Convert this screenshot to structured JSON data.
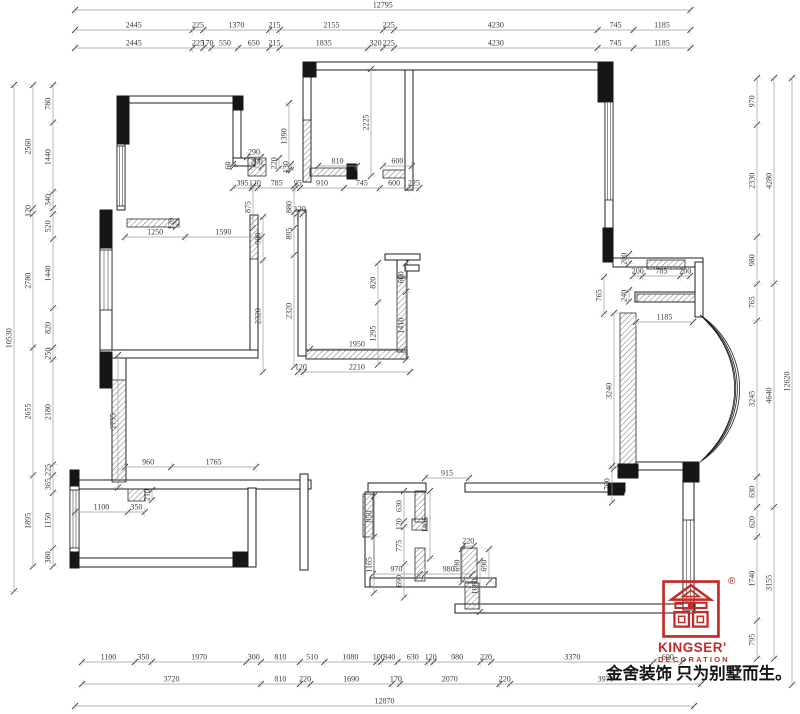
{
  "dims": {
    "top": {
      "total": "12795",
      "row2": [
        "2445",
        "225",
        "1370",
        "215",
        "2155",
        "225",
        "4230",
        "745",
        "1185"
      ],
      "row3": [
        "2445",
        "225",
        "170",
        "550",
        "650",
        "215",
        "1835",
        "320",
        "225",
        "4230",
        "745",
        "1185"
      ]
    },
    "bottom": {
      "row1": [
        "1100",
        "350",
        "1970",
        "300",
        "810",
        "510",
        "1080",
        "100",
        "340",
        "630",
        "120",
        "980",
        "220",
        "3370",
        "600"
      ],
      "row2": [
        "3720",
        "810",
        "220",
        "1690",
        "170",
        "2070",
        "220",
        "3970"
      ],
      "total": "12870"
    },
    "left": {
      "total": "10530",
      "mid": [
        "2560",
        "120",
        "2780",
        "2655",
        "1895"
      ],
      "inner": [
        "780",
        "1440",
        "340",
        "120*",
        "520",
        "1440",
        "820",
        "250",
        "2180",
        "225",
        "365",
        "1150",
        "380"
      ]
    },
    "right": {
      "total": "12620",
      "mid": [
        "4280",
        "4640",
        "3155"
      ],
      "inner": [
        "970",
        "2330",
        "980",
        "765",
        "3245",
        "630",
        "620",
        "1740",
        "795"
      ]
    },
    "interior_h": [
      {
        "x": 233,
        "y": 188,
        "vals": [
          "395",
          "120",
          "785",
          "95",
          "910",
          "745",
          "600",
          "225"
        ]
      },
      {
        "x": 125,
        "y": 237,
        "vals": [
          "1250",
          "1590"
        ]
      },
      {
        "x": 298,
        "y": 372,
        "vals": [
          "120",
          "2210"
        ]
      },
      {
        "x": 310,
        "y": 349,
        "vals": [
          "1950"
        ]
      },
      {
        "x": 425,
        "y": 478,
        "vals": [
          "915"
        ]
      },
      {
        "x": 633,
        "y": 276,
        "vals": [
          "200",
          "785",
          "200"
        ]
      },
      {
        "x": 636,
        "y": 322,
        "vals": [
          "1185"
        ]
      },
      {
        "x": 125,
        "y": 467,
        "vals": [
          "960",
          "1765"
        ]
      },
      {
        "x": 75,
        "y": 512,
        "vals": [
          "1100",
          "350"
        ]
      },
      {
        "x": 247,
        "y": 157,
        "vals": [
          "290"
        ]
      },
      {
        "x": 252,
        "y": 167,
        "vals": [
          "200"
        ]
      },
      {
        "x": 318,
        "y": 166,
        "vals": [
          "810"
        ]
      },
      {
        "x": 383,
        "y": 166,
        "vals": [
          "600"
        ]
      },
      {
        "x": 373,
        "y": 574,
        "vals": [
          "970"
        ]
      },
      {
        "x": 425,
        "y": 574,
        "vals": [
          "980"
        ]
      },
      {
        "x": 463,
        "y": 546,
        "vals": [
          "220"
        ]
      },
      {
        "x": 297,
        "y": 214,
        "vals": [
          "120"
        ]
      }
    ],
    "interior_v": [
      {
        "x": 253,
        "y": 186,
        "vals": [
          "875"
        ]
      },
      {
        "x": 294,
        "y": 186,
        "vals": [
          "880"
        ]
      },
      {
        "x": 263,
        "y": 217,
        "vals": [
          "900",
          "2320"
        ]
      },
      {
        "x": 294,
        "y": 212,
        "vals": [
          "895",
          "2320"
        ]
      },
      {
        "x": 279,
        "y": 158,
        "vals": [
          "220"
        ]
      },
      {
        "x": 233,
        "y": 164,
        "vals": [
          "60"
        ]
      },
      {
        "x": 291,
        "y": 164,
        "vals": [
          "130"
        ]
      },
      {
        "x": 289,
        "y": 103,
        "vals": [
          "1390"
        ]
      },
      {
        "x": 371,
        "y": 69,
        "vals": [
          "2225"
        ]
      },
      {
        "x": 378,
        "y": 263,
        "vals": [
          "820",
          "1295"
        ]
      },
      {
        "x": 406,
        "y": 263,
        "vals": [
          "600",
          "1410"
        ]
      },
      {
        "x": 176,
        "y": 221,
        "vals": [
          "120"
        ]
      },
      {
        "x": 118,
        "y": 355,
        "vals": [
          "2755"
        ]
      },
      {
        "x": 152,
        "y": 490,
        "vals": [
          "210"
        ]
      },
      {
        "x": 604,
        "y": 277,
        "vals": [
          "765"
        ]
      },
      {
        "x": 629,
        "y": 254,
        "vals": [
          "200"
        ]
      },
      {
        "x": 629,
        "y": 290,
        "vals": [
          "240"
        ]
      },
      {
        "x": 614,
        "y": 313,
        "vals": [
          "3240"
        ]
      },
      {
        "x": 612,
        "y": 466,
        "vals": [
          "760"
        ]
      },
      {
        "x": 374,
        "y": 496,
        "vals": [
          "850",
          "1165"
        ]
      },
      {
        "x": 404,
        "y": 491,
        "vals": [
          "630",
          "120",
          "775",
          "690"
        ]
      },
      {
        "x": 430,
        "y": 491,
        "vals": [
          "1405"
        ]
      },
      {
        "x": 462,
        "y": 549,
        "vals": [
          "690"
        ]
      },
      {
        "x": 489,
        "y": 549,
        "vals": [
          "690"
        ]
      },
      {
        "x": 480,
        "y": 561,
        "vals": [
          "1060"
        ]
      }
    ]
  },
  "logo": {
    "brand": "KINGSER'",
    "division": "DECORATION",
    "trademark": "®",
    "color": "#c42a26",
    "slogan": "金舍装饰 只为别墅而生。"
  }
}
